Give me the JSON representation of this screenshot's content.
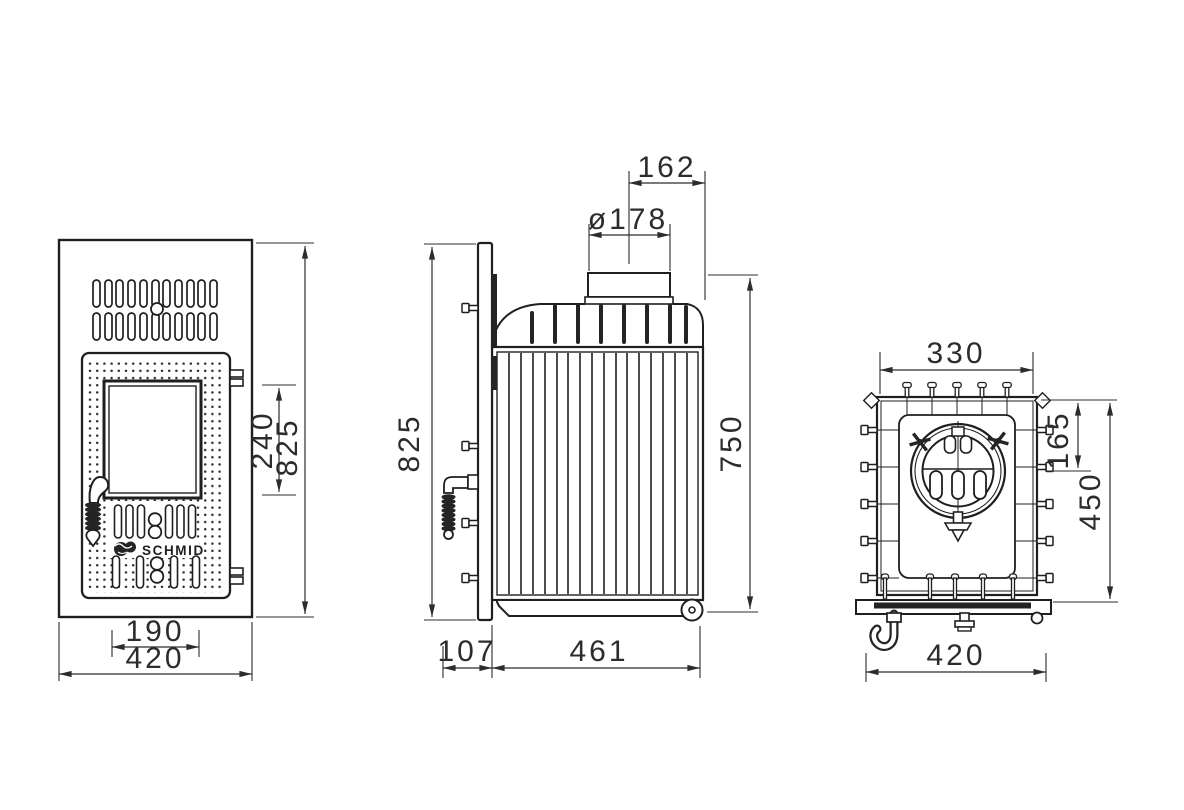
{
  "brand": {
    "name": "SCHMID"
  },
  "views": {
    "front": {
      "dims": {
        "glass_height": "240",
        "total_height": "825",
        "door_width": "190",
        "total_width": "420"
      }
    },
    "side": {
      "dims": {
        "flue_center_to_rear": "162",
        "flue_diameter": "ø178",
        "total_height": "825",
        "body_height": "750",
        "front_depth": "107",
        "body_depth": "461"
      }
    },
    "rear": {
      "dims": {
        "top_width": "330",
        "flue_center_from_top": "165",
        "body_height": "450",
        "base_width": "420"
      }
    }
  }
}
